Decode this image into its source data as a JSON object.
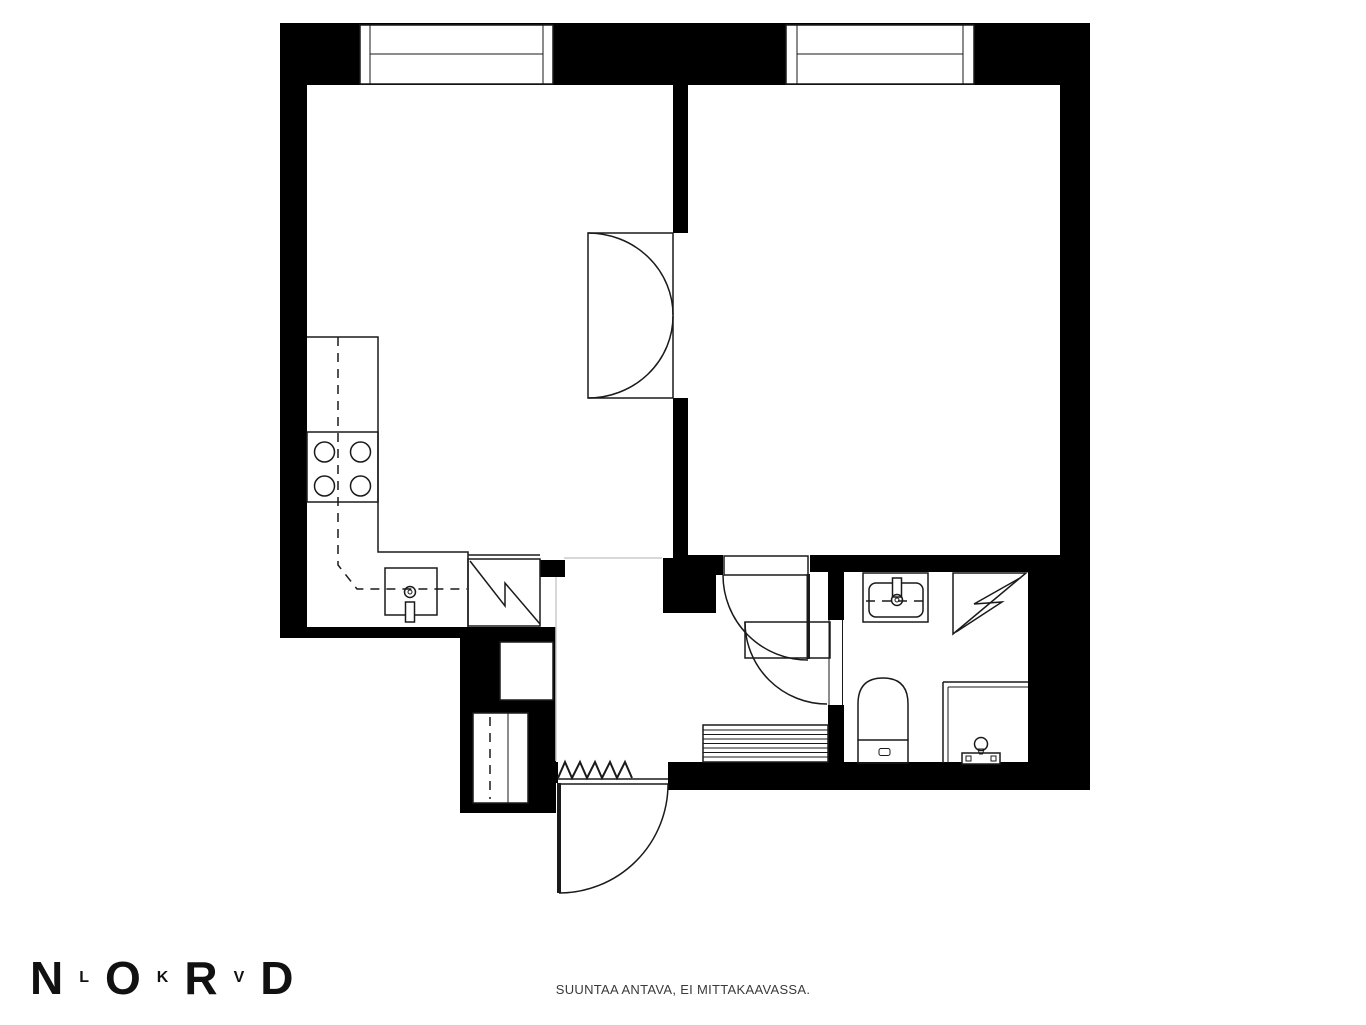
{
  "logo": {
    "letters": [
      {
        "char": "N",
        "size": "large"
      },
      {
        "char": "L",
        "size": "small"
      },
      {
        "char": "O",
        "size": "large"
      },
      {
        "char": "K",
        "size": "small"
      },
      {
        "char": "R",
        "size": "large"
      },
      {
        "char": "V",
        "size": "small"
      },
      {
        "char": "D",
        "size": "large"
      }
    ],
    "color": "#111111"
  },
  "footer": {
    "disclaimer": "SUUNTAA ANTAVA, EI MITTAKAAVASSA."
  },
  "colors": {
    "wall": "#000000",
    "line": "#1a1a1a",
    "guide": "#cccccc",
    "background": "#ffffff"
  },
  "symbols": [
    "window",
    "double-door",
    "interior-door",
    "bathroom-door",
    "entrance-door",
    "doormat-zigzag",
    "kitchen-counter",
    "stove-burners",
    "kitchen-sink",
    "refrigerator",
    "closet-shafts",
    "radiator",
    "washbasin",
    "toilet",
    "shower-corner",
    "shower-enclosure",
    "shower-mixer"
  ]
}
